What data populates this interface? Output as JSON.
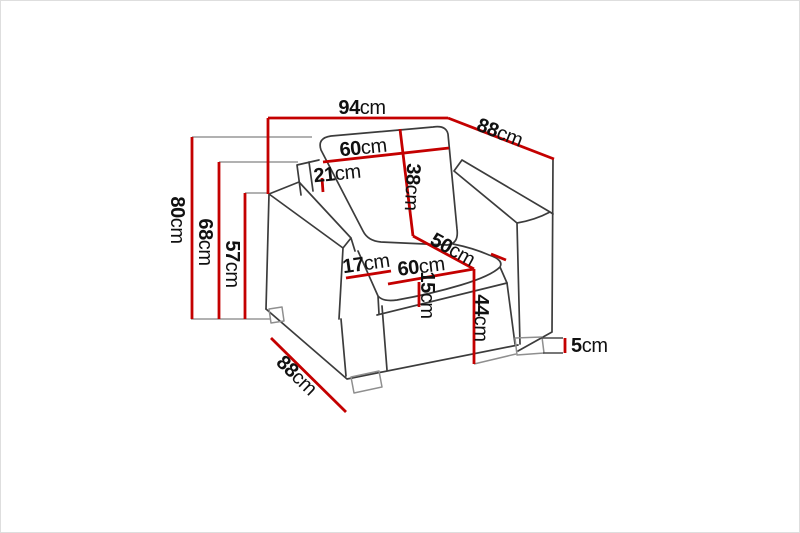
{
  "figure": {
    "title": "armchair-dimension-diagram",
    "subject": "armchair line drawing with measurements",
    "colors": {
      "dimension_line": "#c40000",
      "outline": "#3c3c3c",
      "guide_line": "#979797",
      "text": "#111111",
      "background": "#ffffff",
      "border": "#dedede"
    },
    "unit_label": "cm",
    "dimensions": [
      {
        "name": "overall-width",
        "value": "94",
        "unit": "cm"
      },
      {
        "name": "overall-depth-top",
        "value": "88",
        "unit": "cm"
      },
      {
        "name": "back-cushion-width",
        "value": "60",
        "unit": "cm"
      },
      {
        "name": "back-panel-gap",
        "value": "21",
        "unit": "cm"
      },
      {
        "name": "back-cushion-height",
        "value": "38",
        "unit": "cm"
      },
      {
        "name": "overall-height",
        "value": "80",
        "unit": "cm"
      },
      {
        "name": "armrest-height",
        "value": "68",
        "unit": "cm"
      },
      {
        "name": "seat-back-height",
        "value": "57",
        "unit": "cm"
      },
      {
        "name": "seat-depth",
        "value": "50",
        "unit": "cm"
      },
      {
        "name": "armrest-width",
        "value": "17",
        "unit": "cm"
      },
      {
        "name": "seat-width",
        "value": "60",
        "unit": "cm"
      },
      {
        "name": "seat-cushion-thickness",
        "value": "15",
        "unit": "cm"
      },
      {
        "name": "seat-height",
        "value": "44",
        "unit": "cm"
      },
      {
        "name": "leg-height",
        "value": "5",
        "unit": "cm"
      },
      {
        "name": "overall-depth-bottom",
        "value": "88",
        "unit": "cm"
      }
    ]
  }
}
